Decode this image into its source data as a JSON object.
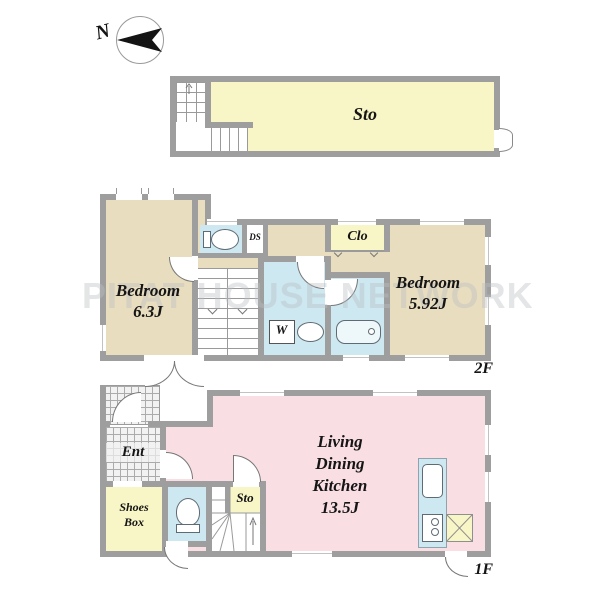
{
  "compass": {
    "north_label": "N"
  },
  "watermark": {
    "text": "PITAT HOUSE NETWORK"
  },
  "attic": {
    "rooms": {
      "storage": {
        "label": "Sto"
      }
    }
  },
  "floor2": {
    "floor_label": "2F",
    "rooms": {
      "bedroom_west": {
        "label": "Bedroom",
        "area": "6.3J"
      },
      "bedroom_east": {
        "label": "Bedroom",
        "area": "5.92J"
      },
      "closet": {
        "label": "Clo"
      },
      "duct_space": {
        "label": "DS"
      },
      "washer": {
        "label": "W"
      }
    }
  },
  "floor1": {
    "floor_label": "1F",
    "rooms": {
      "entrance": {
        "label": "Ent"
      },
      "shoes_box": {
        "label_line1": "Shoes",
        "label_line2": "Box"
      },
      "storage": {
        "label": "Sto"
      },
      "ldk": {
        "label_line1": "Living",
        "label_line2": "Dining",
        "label_line3": "Kitchen",
        "area": "13.5J"
      }
    }
  },
  "colors": {
    "wall": "#9e9e9e",
    "beige": "#e9ddc0",
    "yellow": "#f8f5c6",
    "blue": "#cde8f0",
    "pink": "#f9dfe3"
  }
}
